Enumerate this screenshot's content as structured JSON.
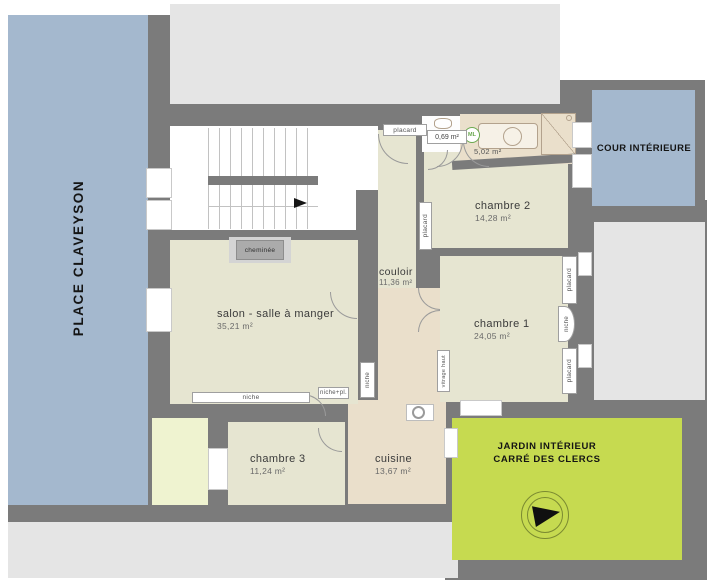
{
  "exterior": {
    "place": "PLACE CLAVEYSON",
    "cour": "COUR INTÉRIEURE",
    "jardin_line1": "JARDIN INTÉRIEUR",
    "jardin_line2": "CARRÉ DES CLERCS"
  },
  "rooms": {
    "salon": {
      "name": "salon - salle à manger",
      "area": "35,21 m²"
    },
    "couloir": {
      "name": "couloir",
      "area": "11,36 m²"
    },
    "chambre1": {
      "name": "chambre 1",
      "area": "24,05 m²"
    },
    "chambre2": {
      "name": "chambre 2",
      "area": "14,28 m²"
    },
    "chambre3": {
      "name": "chambre 3",
      "area": "11,24 m²"
    },
    "cuisine": {
      "name": "cuisine",
      "area": "13,67 m²"
    },
    "wc": {
      "area": "0,69 m²"
    },
    "sdb": {
      "area": "5,02 m²"
    }
  },
  "features": {
    "cheminee": "cheminée",
    "placard": "placard",
    "niche": "niche",
    "niche_pl": "niche+pl.",
    "vitrage_haut": "vitrage haut",
    "ml": "ML"
  },
  "legend_colors": {
    "wall": "#7b7b7b",
    "adjacent_building": "#e5e5e5",
    "street_blue": "#a4b8ce",
    "room_beige_green": "#e6e5d1",
    "room_tan": "#eadfcb",
    "garden_green": "#c6da50",
    "lightwell_yellow": "#eff3d0"
  }
}
